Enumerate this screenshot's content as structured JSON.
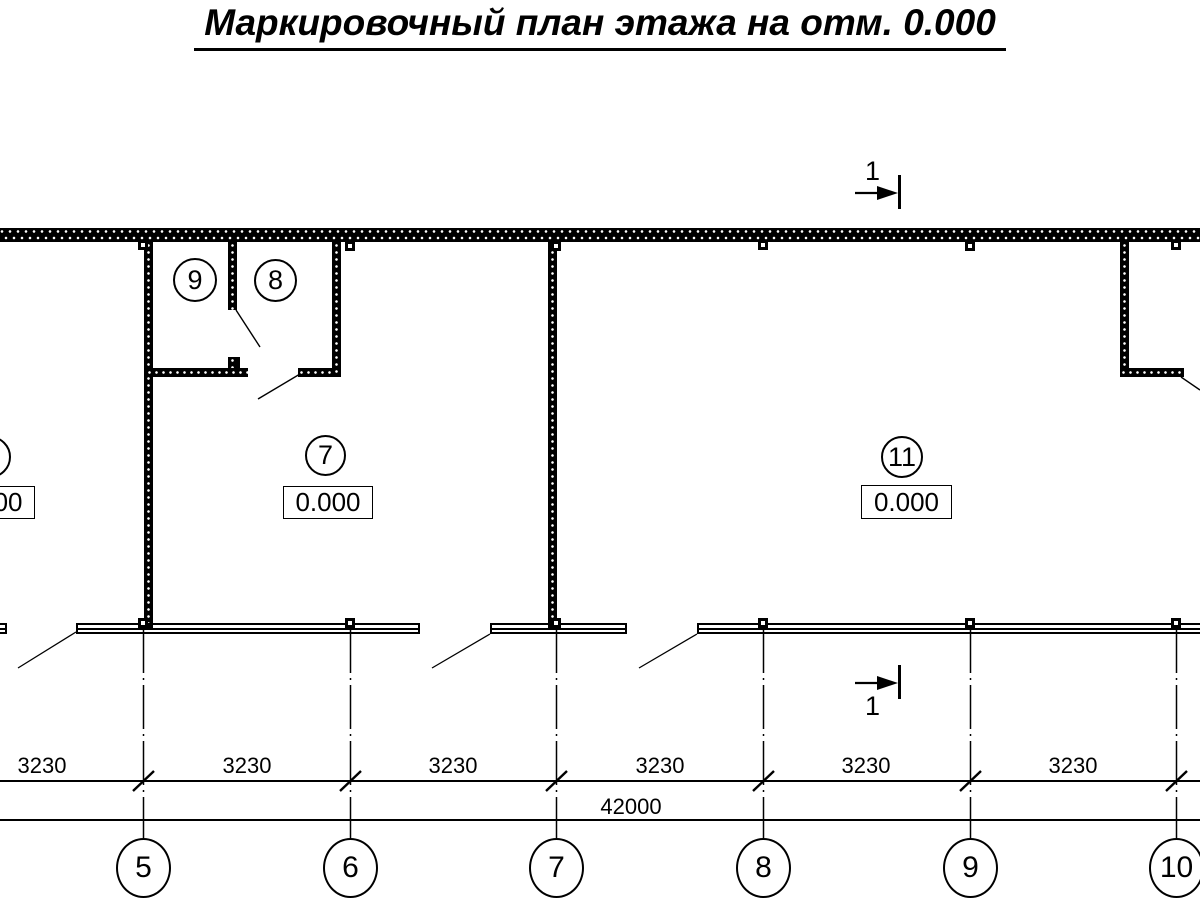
{
  "title": {
    "text": "Маркировочный план этажа на отм. 0.000"
  },
  "section": {
    "label": "1"
  },
  "rooms": {
    "r9": {
      "number": "9"
    },
    "r8": {
      "number": "8"
    },
    "r7": {
      "number": "7",
      "elevation": "0.000"
    },
    "r11": {
      "number": "11",
      "elevation": "0.000"
    },
    "r_left": {
      "elevation": "0.000"
    }
  },
  "dims": {
    "bays": [
      "3230",
      "3230",
      "3230",
      "3230",
      "3230",
      "3230"
    ],
    "total": "42000"
  },
  "axes": [
    "5",
    "6",
    "7",
    "8",
    "9",
    "10"
  ],
  "colors": {
    "line": "#000000",
    "background": "#ffffff"
  }
}
